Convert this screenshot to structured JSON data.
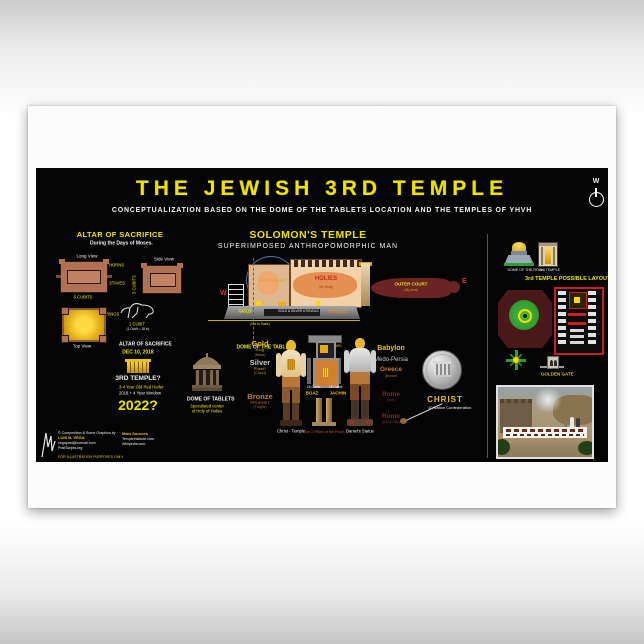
{
  "colors": {
    "poster_black": "#040404",
    "accent_yellow": "#ede300",
    "gold": "#e8b830",
    "silver": "#c8c8c8",
    "bronze": "#b87333",
    "maroon": "#6a2424",
    "red": "#e03030",
    "plan_red": "#cc2020",
    "green": "#2f9f2f"
  },
  "header": {
    "title": "THE JEWISH 3RD TEMPLE",
    "subtitle": "CONCEPTUALIZATION BASED ON THE DOME OF THE TABLETS LOCATION AND THE TEMPLES OF YHVH",
    "compass_letter": "W"
  },
  "altar": {
    "heading": "ALTAR OF SACRIFICE",
    "subheading": "During the Days of Moses.",
    "long_view": "Long View",
    "side_view": "Side View",
    "top_view": "Top View",
    "horns": "HORNS",
    "staves": "STAVES",
    "rings": "RINGS",
    "dim_width": "5 CUBITS",
    "dim_height": "3 CUBITS",
    "dim_cubit": "1 CUBIT",
    "cubit_note": "(1 Cubit = 18 in)",
    "title2": "ALTAR OF SACRIFICE",
    "date": "DEC 10, 2018",
    "temple_question": "3RD TEMPLE?",
    "heifer_note": "3-4 Year Old Red Heifer",
    "window_note": "2018 + 4 Year Window",
    "year_question": "2022?"
  },
  "dome_tablets": {
    "name": "DOME OF TABLETS",
    "note1": "Speculated center",
    "note2": "of Holy of Holies"
  },
  "temple": {
    "title": "SOLOMON'S TEMPLE",
    "subtitle": "SUPERIMPOSED ANTHROPOMORPHIC MAN",
    "west": "W",
    "east": "E",
    "holy_of_holies": "HOLY OF HOLIES",
    "holies": "HOLIES",
    "holies_note": "(My Body)",
    "outer_court": "OUTER COURT",
    "outer_court_note": "(My Arm)",
    "gold_label": "GOLD",
    "utensils_label": "GOLD & SILVER UTENSILS",
    "bronze_label": "BRONZE",
    "scale_note": "(Not to Scale)",
    "dome_line_label": "DOME OF THE TABLETS"
  },
  "figures": {
    "metals": [
      {
        "metal": "Gold",
        "role": "King",
        "note": "(Head)"
      },
      {
        "metal": "Silver",
        "role": "Priest?",
        "note": "(Chest)"
      },
      {
        "metal": "Bronze",
        "role": "PROPHET",
        "note": "(Thighs)"
      }
    ],
    "left_figure_label": "Christ - Temple",
    "right_figure_label": "Daniel's Statue",
    "ark_label": "ARK",
    "pillar_left": "BOAZ",
    "pillar_right": "JACHIN",
    "pillar_dim_left": "18 Cubits",
    "pillar_dim_right": "18 Cubits",
    "pillars_caption": "The 2 Pillars of the Porch",
    "empires": [
      {
        "name": "Babylon",
        "note": ""
      },
      {
        "name": "Medo-Persia",
        "note": ""
      },
      {
        "name": "Greece",
        "note": "(Bronze)"
      },
      {
        "name": "Rome",
        "note": "(Iron)"
      },
      {
        "name": "Rome",
        "note": "(Iron & Clay)"
      }
    ],
    "christ": "CHRIST",
    "christ_note": "10 Nation Confederation."
  },
  "layout": {
    "dome_rock_label": "DOME OF THE ROCK",
    "temple_icon_label": "3rd TEMPLE",
    "heading": "3rd TEMPLE POSSIBLE LAYOUT",
    "golden_gate": "GOLDEN GATE"
  },
  "credits": {
    "line1": "© Composition & Some Graphics by",
    "author": "LUIS B. VEGA",
    "email": "vegapost@hotmail.com",
    "site": "PostScripts.org",
    "disclaimer": "FOR ILLUSTRATION PURPOSES ONLY",
    "sources_title": "Main Sources",
    "source1": "TempleInstitute.com",
    "source2": "Wikipedia.com"
  }
}
